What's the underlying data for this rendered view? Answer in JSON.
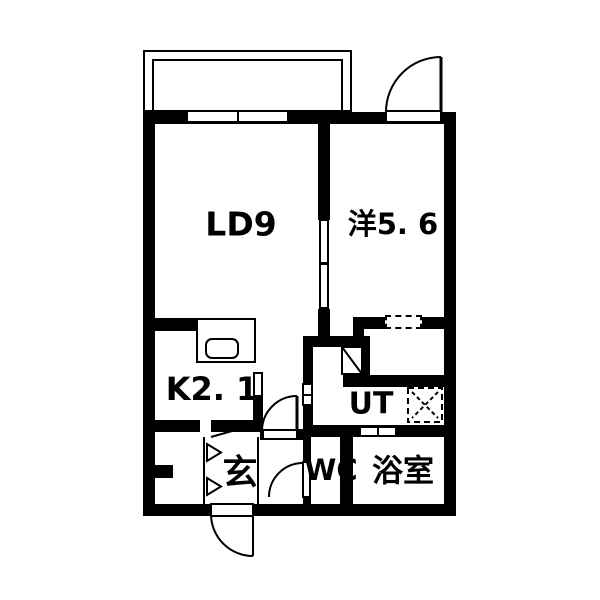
{
  "plan": {
    "title": "apartment floor plan",
    "rooms": [
      {
        "id": "living-dining",
        "label": "LD9"
      },
      {
        "id": "western-room",
        "label": "洋5. 6"
      },
      {
        "id": "kitchen",
        "label": "K2. 1"
      },
      {
        "id": "utility",
        "label": "UT"
      },
      {
        "id": "entrance",
        "label": "玄"
      },
      {
        "id": "toilet",
        "label": "WC"
      },
      {
        "id": "bathroom",
        "label": "浴室"
      }
    ],
    "symbols": [
      "washing-machine-icon",
      "sink-icon",
      "vanity-icon",
      "door-swing-arc",
      "shoe-shelf-arrows"
    ],
    "colors": {
      "wall": "#000000",
      "background": "#ffffff",
      "line": "#000000"
    }
  }
}
